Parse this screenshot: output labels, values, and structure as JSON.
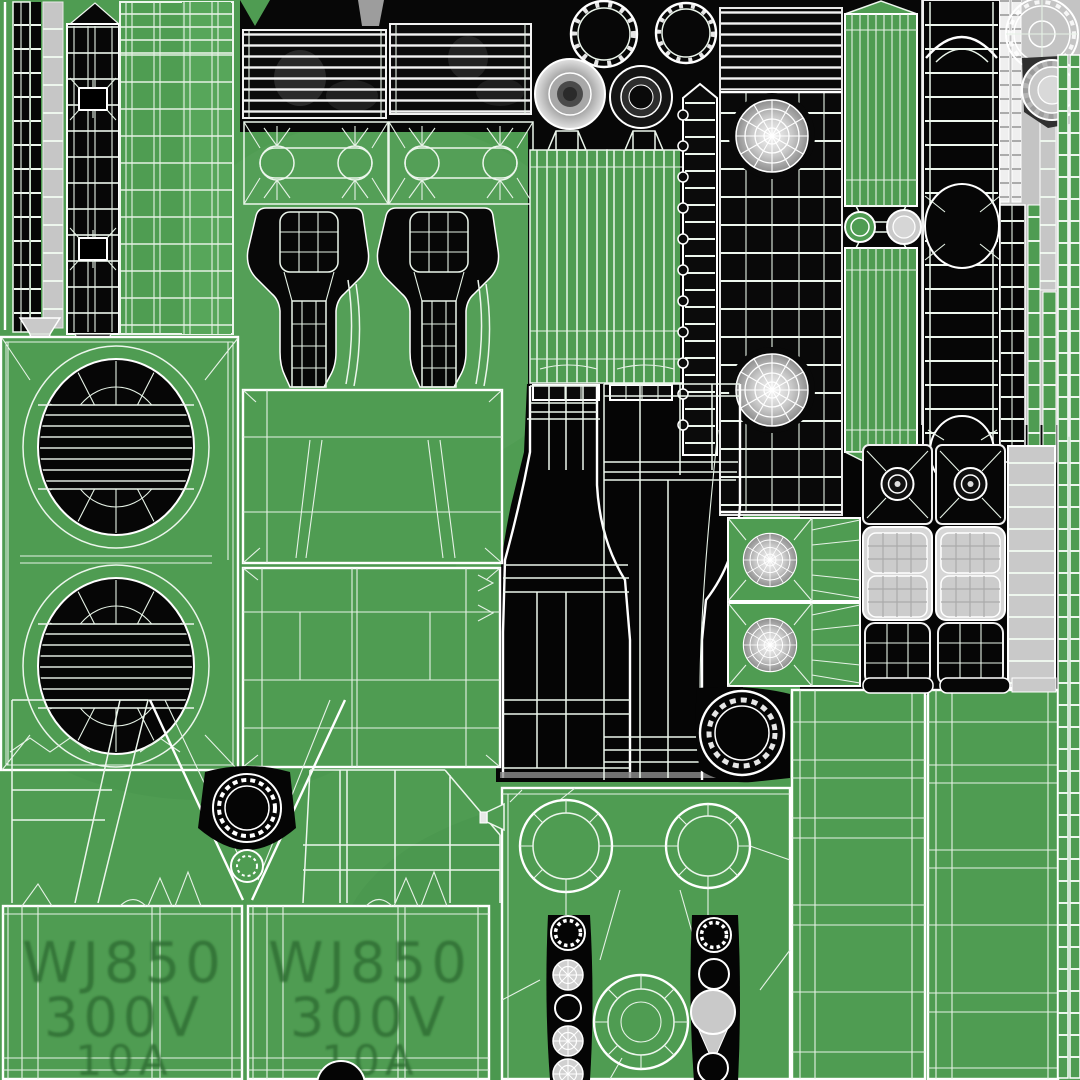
{
  "scene": {
    "kind": "uv-texture-atlas",
    "description": "Wireframe UV unwrap texture of a power-strip 3D model",
    "palette": {
      "base_green": "#4F9C52",
      "light_green_band": "#57A65A",
      "wire_white": "#ECF6EC",
      "island_black": "#070707",
      "light_gray": "#C6C6C6",
      "mid_gray": "#9A9A9A",
      "marking_green": "#2E6B33"
    },
    "model_markings": {
      "left_plate": [
        "WJ850",
        "300V",
        "10A"
      ],
      "right_plate": [
        "WJ850",
        "300V",
        "10A"
      ]
    }
  }
}
